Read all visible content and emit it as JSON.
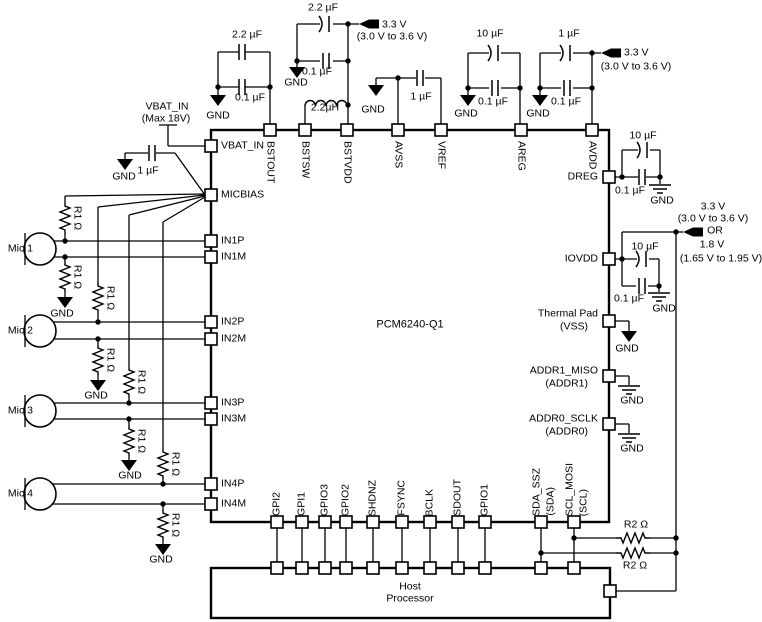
{
  "chip": {
    "name": "PCM6240-Q1"
  },
  "host": {
    "line1": "Host",
    "line2": "Processor"
  },
  "pins": {
    "top": [
      "BSTOUT",
      "BSTSW",
      "BSTVDD",
      "AVSS",
      "VREF",
      "AREG",
      "AVDD"
    ],
    "left": [
      "VBAT_IN",
      "MICBIAS",
      "IN1P",
      "IN1M",
      "IN2P",
      "IN2M",
      "IN3P",
      "IN3M",
      "IN4P",
      "IN4M"
    ],
    "right": {
      "dreg": "DREG",
      "iovdd": "IOVDD",
      "thermal1": "Thermal Pad",
      "thermal2": "(VSS)",
      "addr1a": "ADDR1_MISO",
      "addr1b": "(ADDR1)",
      "addr0a": "ADDR0_SCLK",
      "addr0b": "(ADDR0)"
    },
    "bottom": [
      "GPI2",
      "GPI1",
      "GPIO3",
      "GPIO2",
      "SHDNZ",
      "FSYNC",
      "BCLK",
      "SDOUT",
      "GPIO1"
    ],
    "sda1": "SDA_SSZ",
    "sda2": "(SDA)",
    "scl1": "SCL_MOSI",
    "scl2": "(SCL)"
  },
  "supply": {
    "v33": "3.3 V",
    "v33range": "(3.0 V to 3.6 V)",
    "or": "OR",
    "v18": "1.8 V",
    "v18range": "(1.65 V to 1.95 V)"
  },
  "vbat": {
    "name": "VBAT_IN",
    "max": "(Max 18V)"
  },
  "components": {
    "c22uf": "2.2 µF",
    "c01uf": "0.1 µF",
    "c10uf": "10 µF",
    "c1uf": "1 µF",
    "l22uh": "2.2µH",
    "r1": "R1 Ω",
    "r2": "R2 Ω"
  },
  "gnd": "GND",
  "mics": [
    "Mic 1",
    "Mic 2",
    "Mic 3",
    "Mic 4"
  ],
  "colors": {
    "line": "#000000",
    "background": "#ffffff"
  }
}
